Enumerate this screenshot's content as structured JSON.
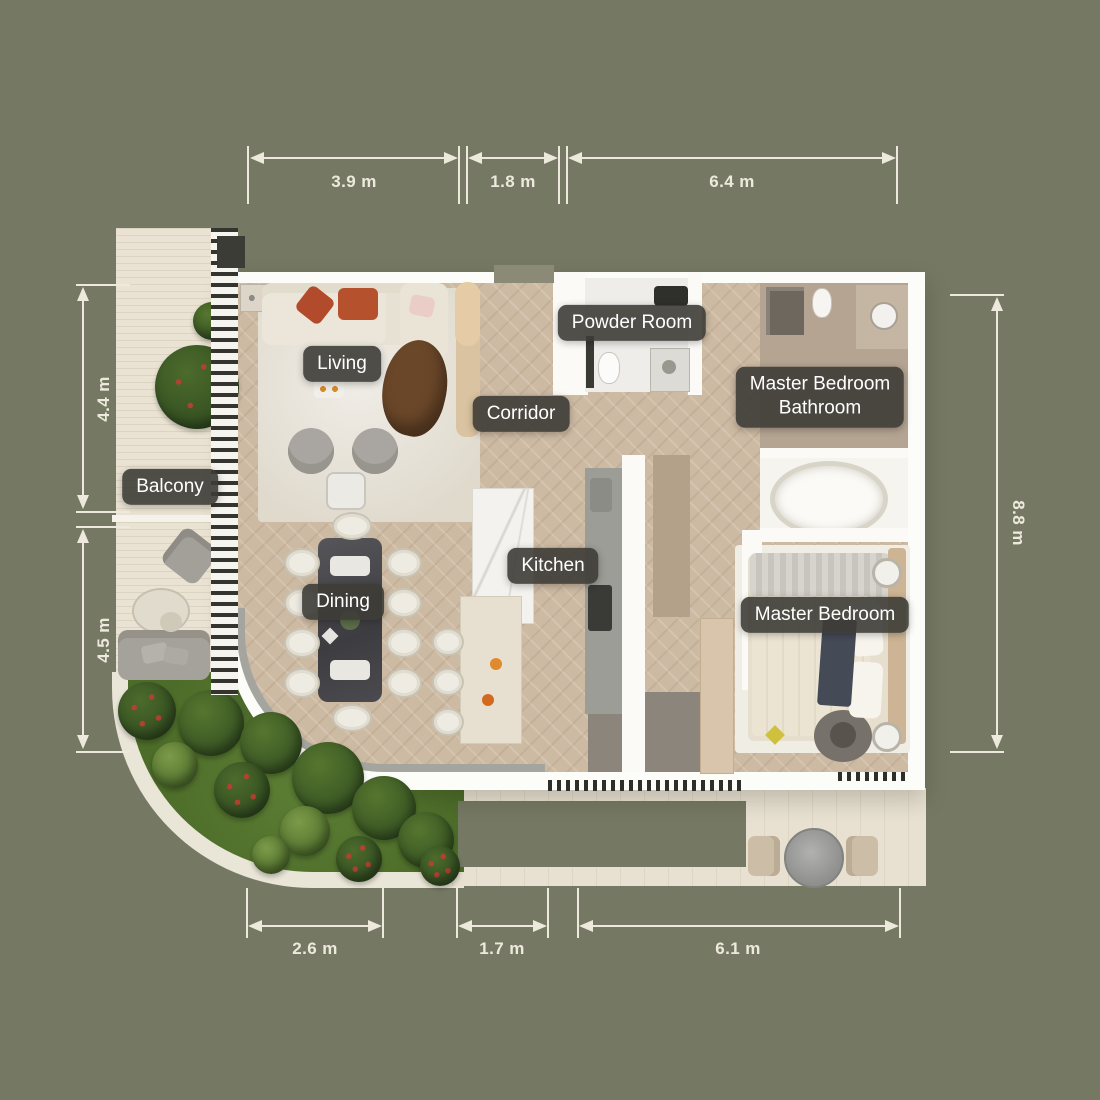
{
  "rooms": {
    "living": {
      "label": "Living"
    },
    "corridor": {
      "label": "Corridor"
    },
    "powder_room": {
      "label": "Powder Room"
    },
    "master_bathroom": {
      "label_line1": "Master Bedroom",
      "label_line2": "Bathroom"
    },
    "balcony": {
      "label": "Balcony"
    },
    "kitchen": {
      "label": "Kitchen"
    },
    "dining": {
      "label": "Dining"
    },
    "master_bedroom": {
      "label": "Master Bedroom"
    }
  },
  "dimensions": {
    "top": [
      {
        "value": "3.9 m"
      },
      {
        "value": "1.8 m"
      },
      {
        "value": "6.4 m"
      }
    ],
    "bottom": [
      {
        "value": "2.6 m"
      },
      {
        "value": "1.7 m"
      },
      {
        "value": "6.1 m"
      }
    ],
    "left": [
      {
        "value": "4.4 m"
      },
      {
        "value": "4.5 m"
      }
    ],
    "right": [
      {
        "value": "8.8 m"
      }
    ]
  },
  "colors": {
    "background": "#757963",
    "label_background": "rgba(61,60,54,0.9)",
    "label_text": "#ffffff",
    "dimension_lines": "#edeadd",
    "wood_floor": "#cdbaa3",
    "balcony_deck": "#eae3d3",
    "grass": "#567931",
    "wall_white": "#fcfcf9"
  }
}
